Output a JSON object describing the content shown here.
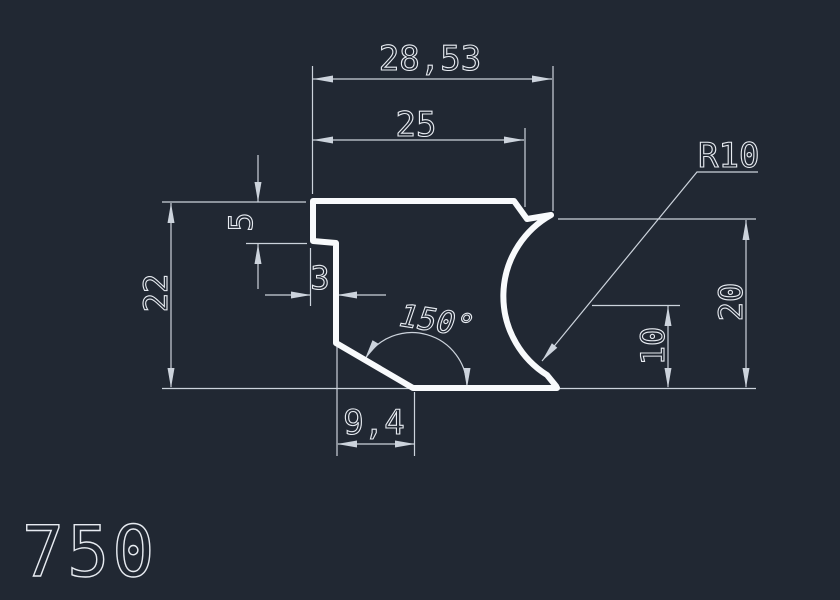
{
  "drawing": {
    "number": "750",
    "colors": {
      "background": "#212833",
      "profile": "#f8fafc",
      "dimension": "#ccd3dc",
      "text": "#e7ebf1"
    },
    "dimensions": {
      "overall_width": "28,53",
      "top_width": "25",
      "corner_radius": "R10",
      "overall_height": "22",
      "step_height": "5",
      "step_width": "3",
      "chamfer_angle": "150°",
      "right_height": "20",
      "radius_center_height": "10",
      "bottom_width": "9,4"
    }
  }
}
